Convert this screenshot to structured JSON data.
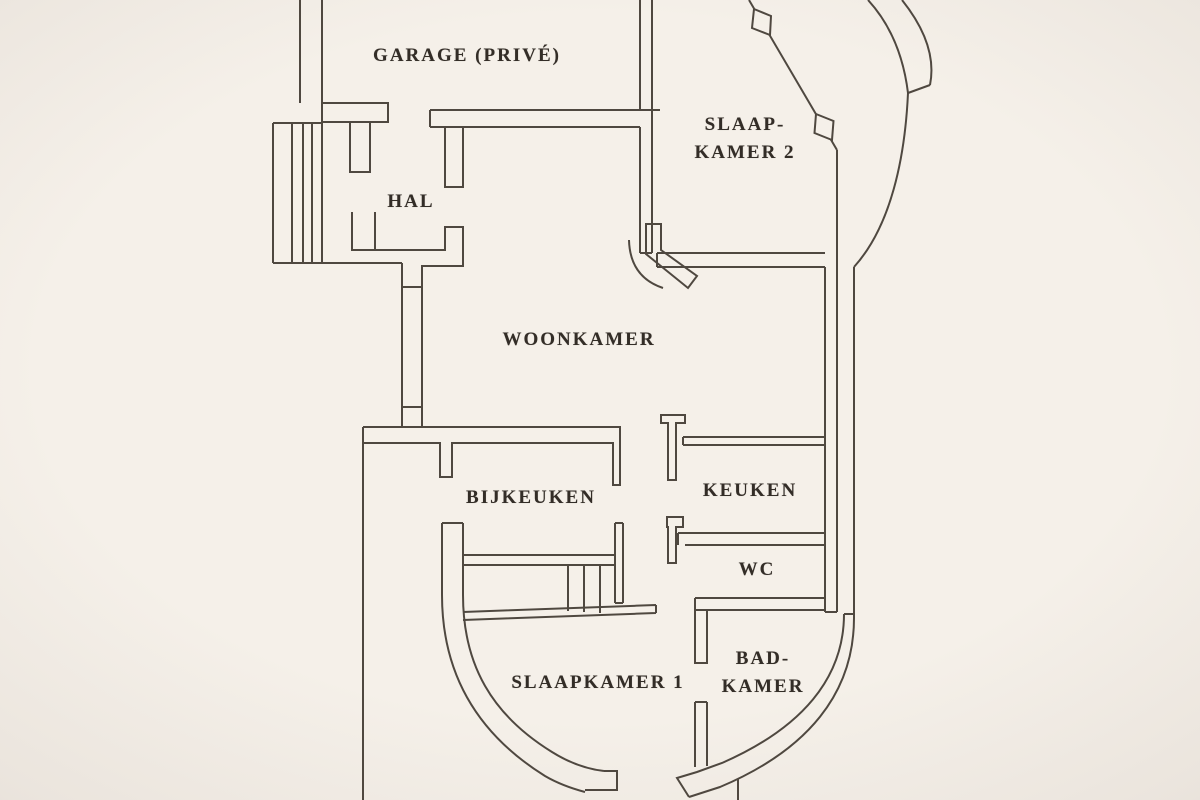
{
  "floorplan": {
    "background_color": "#f5f0e9",
    "line_color": "#4f4840",
    "text_color": "#332d27",
    "rooms": [
      {
        "id": "garage",
        "lines": [
          "GARAGE (PRIVÉ)"
        ],
        "cx": 467,
        "cy": 56
      },
      {
        "id": "slaapkamer-2",
        "lines": [
          "SLAAP-",
          "KAMER 2"
        ],
        "cx": 745,
        "cy": 139
      },
      {
        "id": "hal",
        "lines": [
          "HAL"
        ],
        "cx": 411,
        "cy": 202
      },
      {
        "id": "woonkamer",
        "lines": [
          "WOONKAMER"
        ],
        "cx": 579,
        "cy": 340
      },
      {
        "id": "bijkeuken",
        "lines": [
          "BIJKEUKEN"
        ],
        "cx": 531,
        "cy": 498
      },
      {
        "id": "keuken",
        "lines": [
          "KEUKEN"
        ],
        "cx": 750,
        "cy": 491
      },
      {
        "id": "wc",
        "lines": [
          "WC"
        ],
        "cx": 757,
        "cy": 570
      },
      {
        "id": "slaapkamer-1",
        "lines": [
          "SLAAPKAMER 1"
        ],
        "cx": 598,
        "cy": 683
      },
      {
        "id": "badkamer",
        "lines": [
          "BAD-",
          "KAMER"
        ],
        "cx": 763,
        "cy": 673
      }
    ],
    "walls": [
      {
        "id": "garage-west-wall",
        "d": "M300,0 V103 M322,0 V263"
      },
      {
        "id": "garage-south-wall-left",
        "d": "M322,103 H388 V122 H322"
      },
      {
        "id": "hal-door-pillar-left",
        "d": "M350,122 V172 H370 V122"
      },
      {
        "id": "garage-south-wall-right",
        "d": "M430,110 H660 M430,127 H640 M430,110 V127"
      },
      {
        "id": "garage-east-wall",
        "d": "M640,0 V110 M652,0 V253 M640,127 V253 M640,253 H652"
      },
      {
        "id": "hal-door-pillar-right",
        "d": "M445,127 V187 H463 V127"
      },
      {
        "id": "entry-steps",
        "d": "M273,123 H322 M273,123 V263 M273,263 H402 M292,123 V263 M303,123 V263 M312,123 V263"
      },
      {
        "id": "hal-south-wall",
        "d": "M352,212 V250 H445 V227 H463 V266 H422 V427 M375,250 V212 M402,263 V427 M402,287 H422 M402,407 H422"
      },
      {
        "id": "woonkamer-south-wall",
        "d": "M363,427 H620 V485 H613 V443 H452 V477 H440 V443 H363 V427"
      },
      {
        "id": "west-outer-wall",
        "d": "M363,427 V800"
      },
      {
        "id": "slaapkamer2-diagonal-wall",
        "d": "M749,0 L837,150"
      },
      {
        "id": "slaapkamer2-east-wall",
        "d": "M837,150 V612 M825,267 V612 M825,612 H837"
      },
      {
        "id": "slaapkamer2-south-wall",
        "d": "M657,253 H825 M657,267 H825 M657,253 V267"
      },
      {
        "id": "keuken-north-wall",
        "d": "M683,437 H825 M683,445 H825 M683,437 V445"
      },
      {
        "id": "keuken-door-jamb",
        "d": "M661,415 H685 V423 H676 V480 H668 V423 H661 Z"
      },
      {
        "id": "keuken-south-wall",
        "d": "M678,533 H825 M685,545 H825 M678,533 V545"
      },
      {
        "id": "wc-door-jamb",
        "d": "M667,517 H683 V527 H676 V563 H668 V527 H667 Z"
      },
      {
        "id": "wc-south-wall",
        "d": "M695,598 H825 M695,610 H825 M695,598 V610"
      },
      {
        "id": "badkamer-west-wall-upper",
        "d": "M695,598 V663 H707 V610"
      },
      {
        "id": "badkamer-west-wall-lower",
        "d": "M695,702 H707 M695,702 V767 M707,702 V766"
      },
      {
        "id": "bijkeuken-east-wall",
        "d": "M615,523 H623 M615,523 V603 M623,523 V603 M615,603 H623"
      },
      {
        "id": "stairs-landing",
        "d": "M463,555 H615 M463,565 H615"
      },
      {
        "id": "stairs-treads",
        "d": "M568,565 V611 M584,565 V612 M600,565 V613"
      },
      {
        "id": "stairs-lip",
        "d": "M463,612 L656,605 M463,620 L656,613 M656,605 V613"
      },
      {
        "id": "slaapkamer1-curved-wall",
        "d": "M442,523 V595 C442,672 476,733 545,776 C557,783 570,788 585,792 M463,523 V595 C463,665 492,715 552,752 C568,762 586,769 604,771 M442,523 H463 M604,771 H617 V790 H585"
      },
      {
        "id": "badkamer-curved-wall",
        "d": "M854,618 C854,693 808,750 720,787 L689,797 M844,614 C844,678 802,728 722,763 L697,772 M844,614 H854 M697,772 L677,778 L689,797"
      },
      {
        "id": "bottom-edge-stub",
        "d": "M738,779 V800"
      },
      {
        "id": "exterior-curved-bay",
        "d": "M868,0 Q901,36 908,93 M902,0 Q938,45 930,85 M908,93 L930,85"
      },
      {
        "id": "east-outer-wall",
        "d": "M908,93 C905,158 891,226 854,267 M854,267 V618"
      }
    ],
    "doors": [
      {
        "id": "slaapkamer2-door-leaf",
        "d": "M646,224 V254 L688,288 L697,276 L661,250 V224 Z"
      },
      {
        "id": "slaapkamer2-door-swing",
        "d": "M629,240 Q630,277 663,288"
      }
    ],
    "windows": [
      {
        "id": "diagonal-window-upper",
        "points": "754,9 771,16 770,35 752,28"
      },
      {
        "id": "diagonal-window-lower",
        "points": "816,114 833.5,121 832,140 814.5,133"
      }
    ]
  }
}
